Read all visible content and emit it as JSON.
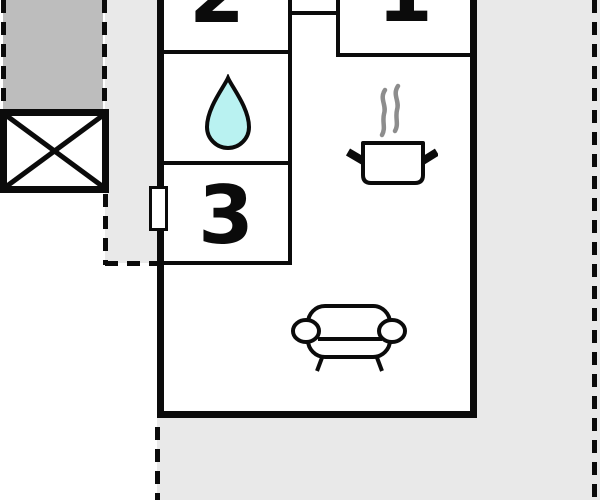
{
  "title": "Apartment floor plan",
  "rooms": [
    {
      "name": "room-1",
      "label": "1"
    },
    {
      "name": "room-2",
      "label": "2"
    },
    {
      "name": "room-3",
      "label": "3"
    },
    {
      "name": "bathroom",
      "icon": "water-drop-icon"
    },
    {
      "name": "kitchen",
      "icon": "cooking-pot-icon"
    },
    {
      "name": "living-room",
      "icon": "sofa-icon"
    }
  ],
  "markers": {
    "elevator": "crossed-box-icon",
    "window": "window-marker",
    "boundary": "dashed-line"
  },
  "colors": {
    "wall": "#0b0b0b",
    "darkArea": "#bdbdbd",
    "lightArea": "#e9e9e9",
    "dropFill": "#b9f2f1",
    "steam": "#8d8d8d",
    "background": "#ffffff"
  }
}
